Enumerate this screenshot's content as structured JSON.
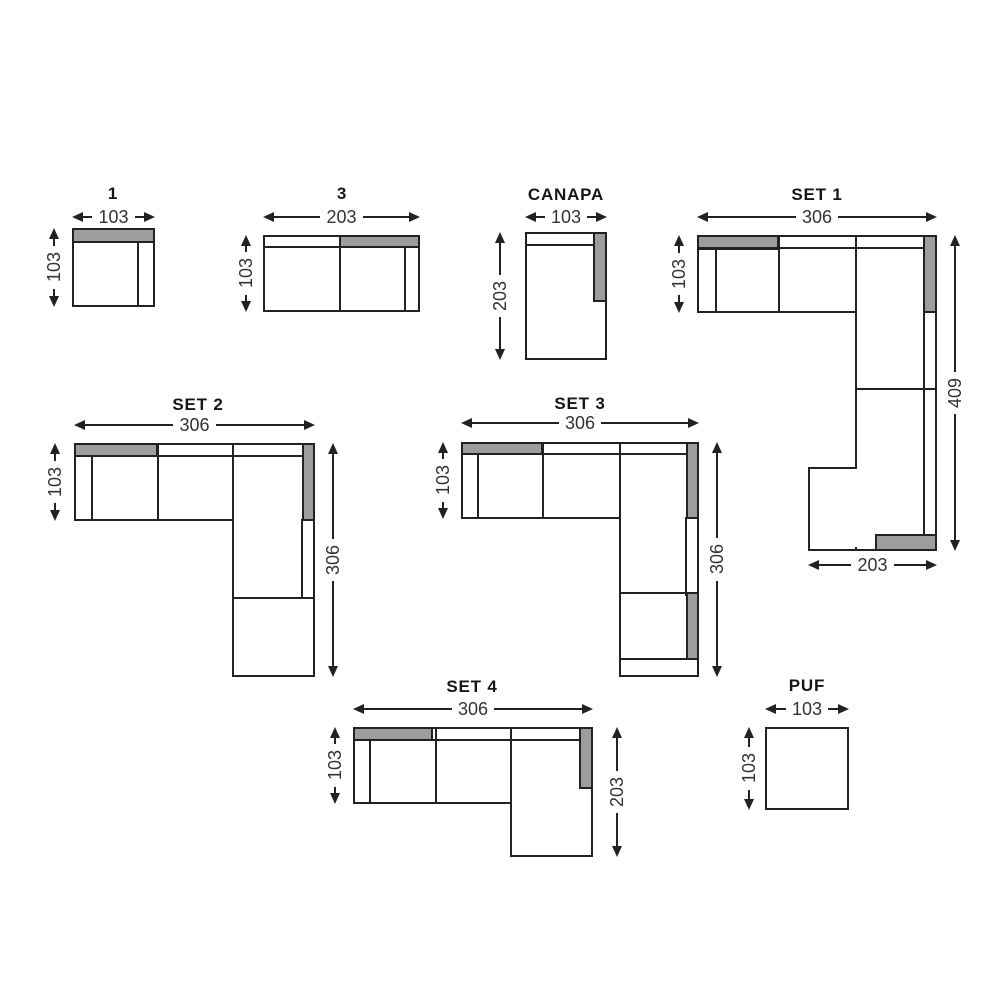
{
  "colors": {
    "gray_fill": "#9c9e9d",
    "line": "#222222",
    "text": "#333333",
    "background": "#ffffff"
  },
  "modules": {
    "one": {
      "label": "1",
      "width": "103",
      "depth": "103"
    },
    "three": {
      "label": "3",
      "width": "203",
      "depth": "103"
    },
    "canapa": {
      "label": "CANAPA",
      "width": "103",
      "depth": "203"
    },
    "set1": {
      "label": "SET 1",
      "width": "306",
      "depth": "103",
      "right_height": "409",
      "bottom_width": "203"
    },
    "set2": {
      "label": "SET 2",
      "width": "306",
      "depth": "103",
      "right_height": "306"
    },
    "set3": {
      "label": "SET 3",
      "width": "306",
      "depth": "103",
      "right_height": "306"
    },
    "set4": {
      "label": "SET 4",
      "width": "306",
      "depth": "103",
      "right_height": "203"
    },
    "puf": {
      "label": "PUF",
      "width": "103",
      "depth": "103"
    }
  }
}
